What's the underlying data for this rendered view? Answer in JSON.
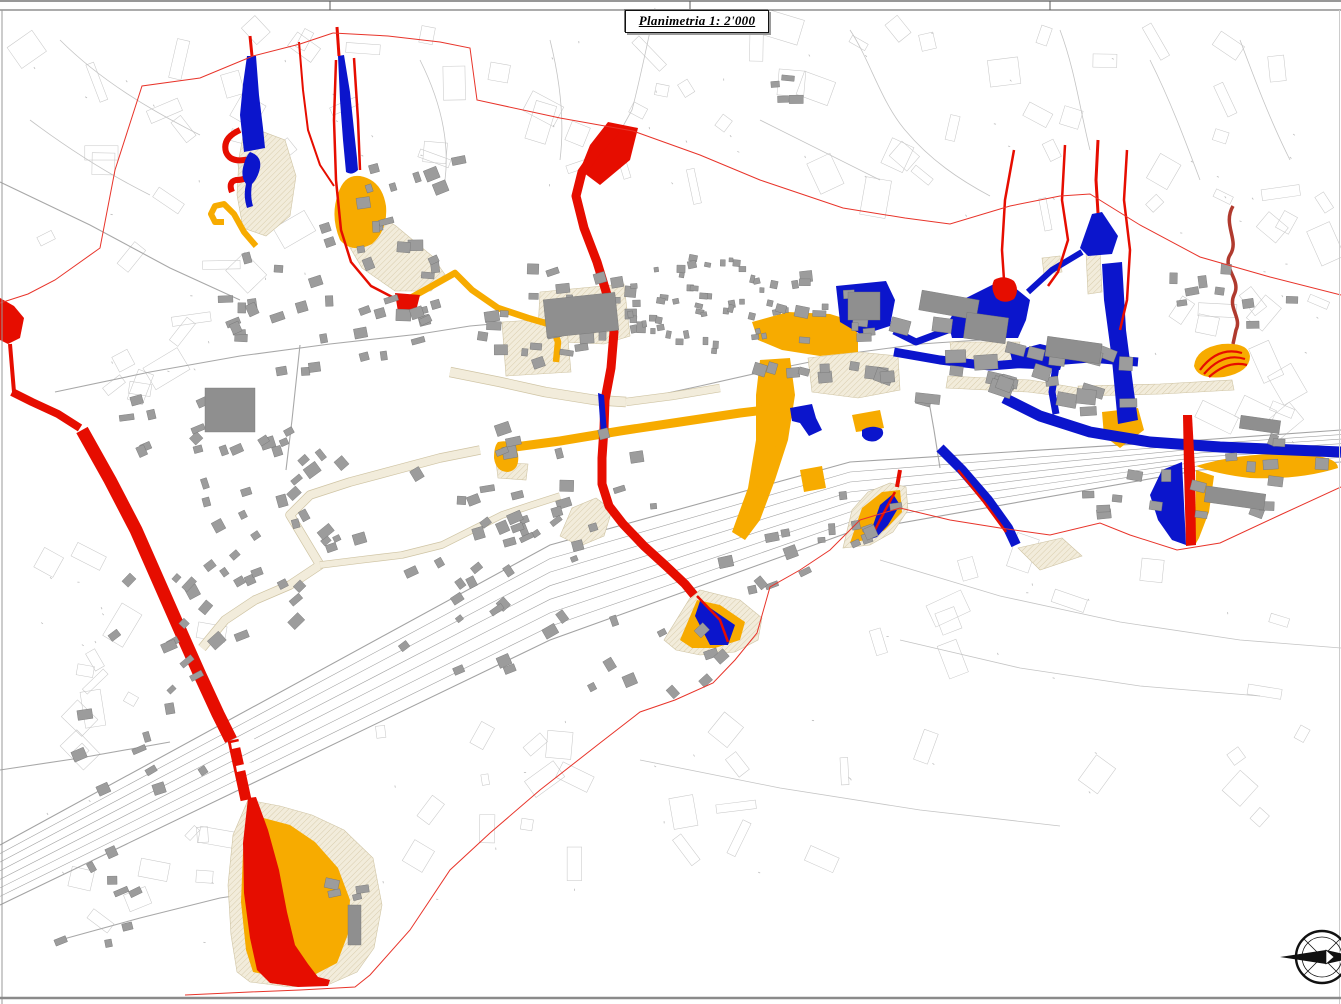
{
  "title_box": {
    "label": "Planimetria 1: 2'000"
  },
  "frame": {
    "band_height": 10,
    "tick_x": [
      330,
      690,
      1050
    ]
  },
  "colors": {
    "paper": "#ffffff",
    "red_zone": "#e60d00",
    "red_perimeter": "#e8342a",
    "dark_red_line": "#b03a2e",
    "blue_zone": "#0b15cc",
    "orange_zone": "#f7ab00",
    "beige_zone": "#f2ecdb",
    "beige_hatch": "#d9cdad",
    "beige_edge": "#cfc4a4",
    "building_fill": "#9c9c9c",
    "building_stroke": "#757575",
    "parcel_line": "#c9c9c9",
    "road_line": "#a8a8a8",
    "rail_line": "#a3a3a3",
    "frame_line": "#5a5a5a"
  },
  "map": {
    "width": 1341,
    "height": 1004,
    "corridor": {
      "top": [
        [
          0,
          845
        ],
        [
          550,
          545
        ],
        [
          850,
          462
        ],
        [
          1200,
          440
        ],
        [
          1341,
          430
        ]
      ],
      "bottom": [
        [
          0,
          905
        ],
        [
          550,
          640
        ],
        [
          850,
          532
        ],
        [
          1200,
          470
        ],
        [
          1341,
          462
        ]
      ],
      "lines": 8
    },
    "roads": [
      "M55,392 L150,372 L240,356 L330,344 L420,334 L470,326 L560,318",
      "M0,182 L90,225 L170,268 L240,300",
      "M626,402 L700,386 L780,368 L860,352",
      "M300,345 L292,420 L286,470",
      "M0,770 L80,758 L170,742",
      "M60,940 L140,918 L220,898 L300,886",
      "M940,468 L934,430 L928,396",
      "M860,352 L920,344 L980,340"
    ],
    "terrain_lines": [
      "M655,8 C648,40 640,80 632,110 L622,128",
      "M850,30 C870,60 880,100 905,130 C930,160 960,180 990,196",
      "M1060,30 C1075,70 1080,110 1090,150",
      "M1150,60 C1170,100 1185,140 1200,180",
      "M760,120 C800,140 840,160 880,180",
      "M60,40 C100,80 150,110 200,135",
      "M30,120 C70,150 110,175 150,195",
      "M1240,40 C1255,80 1270,120 1290,160",
      "M880,560 L1000,596 L1120,622 L1240,640 L1341,648",
      "M900,640 L1020,668 L1140,686 L1260,696",
      "M640,760 L780,788 L920,810 L1060,826",
      "M420,60 C440,100 450,140 445,180",
      "M550,40 C560,80 565,120 560,160",
      "M518,330 L558,330 L558,362 L518,362 Z",
      "M518,338 L558,338",
      "M518,354 L558,354"
    ],
    "beige_zones": [
      "M245,125 L285,140 L296,176 L290,216 L266,236 L243,228 L237,195 L239,158 Z",
      "M341,190 L396,226 L432,256 L446,276 L431,291 L395,291 L362,268 L342,234 Z",
      "M540,292 L624,284 L630,336 L604,344 L560,342 L538,330 Z",
      "M502,322 L566,318 L571,372 L506,376 Z",
      "M560,536 L572,508 L596,498 L612,510 L604,536 L580,546 Z",
      "M496,462 L528,464 L526,480 L498,478 Z",
      "M808,358 L858,352 L898,356 L900,390 L858,398 L812,392 Z",
      "M950,342 L1020,342 L1010,364 L952,358 Z",
      "M1042,258 L1060,256 L1062,272 L1044,274 Z",
      "M1086,252 L1100,250 L1102,292 L1088,294 Z",
      "M1078,386 L1160,384 L1232,380 L1234,390 L1162,394 L1080,396 Z",
      "M1018,548 L1062,538 L1082,556 L1040,570 Z",
      "M248,800 L233,835 L228,885 L231,935 L237,972 L250,982 L290,987 L330,984 L357,972 L374,948 L382,905 L373,858 L344,830 L312,815 L280,806 Z",
      "M664,640 L690,598 L700,590 L740,600 L762,618 L758,640 L735,652 L700,655 L676,650 Z",
      "M843,548 L852,510 L868,492 L890,483 L906,487 L908,510 L893,532 L870,545 Z",
      "M948,376 L1030,380 L1078,388 L1076,398 L1028,392 L946,388 Z"
    ],
    "beige_bands": [
      {
        "d": "M202,648 L225,620 L255,600 L290,585 L320,565 L305,540 L290,515 L310,495 L350,482 L395,470 L440,458 L480,450",
        "w": 8
      },
      {
        "d": "M320,565 L360,560 L402,555 L442,545 L472,530 L502,515 L532,505 L560,496",
        "w": 6
      },
      {
        "d": "M450,372 L500,382 L545,392 L595,400 L626,402",
        "w": 9
      },
      {
        "d": "M626,402 L672,396 L720,388",
        "w": 7
      }
    ],
    "orange_zones": [
      "M752,322 L788,312 L830,314 L856,322 L858,340 L858,352 L820,356 L782,350 L758,340 Z",
      "M760,360 L790,358 L795,395 L788,440 L775,480 L760,520 L745,540 L732,532 L748,488 L756,440 L756,395 Z",
      "M800,470 L822,466 L826,488 L804,492 Z",
      "M338,194 Q344,174 360,176 Q382,180 386,206 Q388,230 372,244 Q352,254 340,240 Q330,216 338,194 Z",
      "M498,442 Q514,438 518,454 Q520,470 508,472 Q496,472 494,458 Q494,446 498,442 Z",
      "M1194,366 Q1196,348 1222,344 Q1248,342 1250,356 Q1250,372 1224,377 Q1198,380 1194,366 Z",
      "M680,640 L697,600 L720,605 L745,622 L740,640 L715,648 L692,648 Z",
      "M850,543 L862,508 L882,492 L900,490 L902,512 L885,530 L865,540 Z",
      "M252,815 L243,852 L241,902 L246,950 L253,972 L282,978 L314,975 L337,963 L348,934 L350,900 L338,868 L315,842 L290,825 Z",
      "M1196,466 Q1250,450 1310,455 Q1338,458 1338,468 Q1300,480 1250,478 Q1216,474 1196,466 Z",
      "M1102,412 L1138,408 L1144,430 L1120,448 L1104,436 Z",
      "M1196,470 L1214,476 L1209,512 L1199,538 L1195,545 Z",
      "M852,415 L880,410 L884,428 L856,432 Z"
    ],
    "orange_bands": [
      {
        "d": "M500,449 L560,441 L620,431 L680,422 L740,413 L790,407",
        "w": 9
      },
      {
        "d": "M770,410 L773,440 L768,468 L760,488",
        "w": 7
      },
      {
        "d": "M405,301 L432,286 L455,273 L472,290 L498,308 L528,318 L552,325",
        "w": 6.5
      },
      {
        "d": "M552,325 L558,342 L556,362",
        "w": 6.5
      },
      {
        "d": "M256,246 L244,232 L234,214 L224,204 L215,206 L211,214 L215,222 L224,222",
        "w": 6
      }
    ],
    "blue_zones": [
      "M247,56 L256,56 L259,95 L263,128 L265,148 L244,152 L240,115 L243,84 Z",
      "M338,56 L344,55 L350,92 L354,130 L357,158 L358,170 Q352,176 346,172 L343,140 L340,100 Z",
      "M790,408 L812,404 L816,418 L822,430 L809,436 L800,423 L792,421 Z",
      "M862,430 Q872,424 882,429 Q886,436 876,441 Q866,443 862,436 Z",
      "M836,286 L886,281 L895,300 L890,326 L862,335 L840,322 Z",
      "M962,300 L996,283 L1014,287 L1030,300 L1026,320 L1018,338 L952,338 L948,322 Z",
      "M1080,248 L1092,214 L1102,212 L1118,236 L1112,254 L1088,256 Z",
      "M1102,264 L1122,262 L1126,330 L1134,392 L1138,420 L1118,424 L1112,360 L1104,300 Z",
      "M1010,352 L1040,344 L1066,350 L1060,370 L1014,368 Z",
      "M1182,462 L1186,545 L1172,540 L1158,520 L1150,495 L1162,470 Z",
      "M700,601 L735,625 L728,645 L710,645 L695,616 Z",
      "M868,540 L880,505 L893,494 L900,505 L888,525 L877,537 Z"
    ],
    "blue_bands": [
      {
        "d": "M948,330 L916,342 L894,331",
        "w": 7
      },
      {
        "d": "M1082,252 L1052,270 L1028,292",
        "w": 6
      },
      {
        "d": "M894,352 L940,360 L990,366 L1040,362 L1090,358 L1138,362",
        "w": 9
      },
      {
        "d": "M1056,366 L1052,392 L1056,414",
        "w": 7
      },
      {
        "d": "M1004,398 L1040,416 L1090,432 L1150,442 L1220,447 L1341,452",
        "w": 11
      },
      {
        "d": "M940,448 L962,470 L988,500 L1008,528 L1016,545",
        "w": 10
      }
    ],
    "blue_top": [
      "M250,152 Q262,156 260,168 Q258,178 252,184 Q250,196 253,206 L247,208 Q243,196 246,184 Q240,176 244,164 Q246,156 250,152 Z",
      "M598,393 L604,395 L607,433 L601,434 Z"
    ],
    "red_zones": [
      "M0,298 L14,306 L24,318 L20,338 L8,344 L0,340 Z",
      "M608,122 L638,128 L630,160 L600,185 L580,170 L590,145 Z",
      "M395,293 L420,295 L415,315 L398,312 Z",
      "M994,280 Q1004,274 1014,281 Q1020,290 1014,299 Q1004,305 996,298 Q990,288 994,280 Z",
      "M248,798 L256,797 L268,830 L279,870 L287,912 L295,945 L308,964 L318,977 L330,980 L328,986 L298,987 L270,983 L257,970 L250,938 L244,893 L243,843 Z",
      "M1183,415 L1192,415 L1195,470 L1196,545 L1186,546 L1184,470 Z"
    ],
    "red_bands": [
      {
        "d": "M10,344 L12,368 L14,392",
        "w": 4
      },
      {
        "d": "M12,392 L32,402 L58,414 L80,428",
        "w": 8
      },
      {
        "d": "M82,430 L110,480 L136,530 L158,580 L180,630 L200,675 L218,714 L231,740",
        "w": 13
      },
      {
        "d": "M233,740 L240,772 L246,800",
        "w": 11
      },
      {
        "d": "M616,130 L596,152 L582,172 L576,196 L584,228 L597,262 L608,298 L614,332 L611,368 L605,400 L604,428 L602,458 L602,484 L609,506 L623,524 L644,546 L666,566 L685,584 L694,595",
        "w": 9
      },
      {
        "d": "M240,130 Q222,138 226,152 Q230,162 244,160 Q254,158 252,170 Q250,180 236,180 Q228,182 232,192",
        "w": 6
      },
      {
        "d": "M336,60 L334,120 L336,180 L341,230 L351,262 L371,286 L396,299",
        "w": 2.5
      },
      {
        "d": "M354,58 L358,120 L360,170",
        "w": 2.5
      },
      {
        "d": "M337,27 L339,56",
        "w": 3
      },
      {
        "d": "M250,36 L252,56",
        "w": 3
      },
      {
        "d": "M299,42 L303,90 L308,130 L320,165 L334,186",
        "w": 2
      },
      {
        "d": "M697,596 L720,620 L728,642",
        "w": 2.5
      },
      {
        "d": "M895,492 L880,520 L870,540",
        "w": 2.5
      },
      {
        "d": "M900,470 L897,487",
        "w": 4
      },
      {
        "d": "M958,470 L984,502 L1006,532",
        "w": 2.5
      },
      {
        "d": "M1014,150 L1005,200 L1002,250 L1004,280",
        "w": 2.5
      },
      {
        "d": "M1065,145 L1062,200 L1068,240 L1058,272 L1048,286",
        "w": 2.5
      },
      {
        "d": "M1098,140 L1096,180 L1098,213",
        "w": 3
      },
      {
        "d": "M1127,150 L1124,200 L1130,250 L1127,300 L1120,330",
        "w": 2.5
      },
      {
        "d": "M1200,370 Q1218,346 1242,353",
        "w": 2.2
      },
      {
        "d": "M1204,374 Q1223,352 1245,359",
        "w": 2.2
      },
      {
        "d": "M1209,377 Q1228,360 1247,365",
        "w": 2.2
      }
    ],
    "dark_red_lines": [
      {
        "d": "M1233,206 C1222,225 1240,240 1230,255 C1222,268 1242,280 1234,295 C1228,308 1242,318 1236,330 L1233,344",
        "w": 3.5
      }
    ],
    "white_gaps": [
      "M231,743 L254,738 L255,744 L232,749 Z",
      "M236,766 L258,761 L259,767 L237,772 Z"
    ],
    "perimeter": [
      "M333,33 L300,44 L253,56 L200,78 L142,86 L115,170 L100,248 L55,280 L28,294 L0,303",
      "M333,33 L388,36 L440,42 L470,48 L477,100 L560,118 L633,131 L700,155 L760,180 L843,208 L905,218 L950,224 L1010,206 L1060,196 L1090,194 L1140,225 L1200,257 L1270,277 L1341,295",
      "M1341,487 L1280,515 L1220,543 L1177,550 L1130,535 L1100,523 L1050,535 L1000,528 L950,520 L900,508 L860,520 L830,550 L800,570 L770,587 L757,633 L735,660 L713,683 L675,700 L640,712 L600,743 L540,790 L490,833 L450,870 L410,930 L370,975 L355,987 L300,990 L250,992 L185,995"
    ],
    "field_regions": [
      {
        "x": 15,
        "y": 30,
        "w": 390,
        "h": 270,
        "n": 24
      },
      {
        "x": 410,
        "y": 35,
        "w": 280,
        "h": 170,
        "n": 14
      },
      {
        "x": 690,
        "y": 25,
        "w": 320,
        "h": 190,
        "n": 16
      },
      {
        "x": 1010,
        "y": 35,
        "w": 320,
        "h": 180,
        "n": 14
      },
      {
        "x": 1150,
        "y": 195,
        "w": 185,
        "h": 170,
        "n": 10
      },
      {
        "x": 15,
        "y": 555,
        "w": 210,
        "h": 210,
        "n": 12
      },
      {
        "x": 370,
        "y": 690,
        "w": 320,
        "h": 220,
        "n": 12
      },
      {
        "x": 850,
        "y": 545,
        "w": 480,
        "h": 300,
        "n": 16
      },
      {
        "x": 40,
        "y": 310,
        "w": 170,
        "h": 110,
        "n": 7
      },
      {
        "x": 620,
        "y": 690,
        "w": 260,
        "h": 190,
        "n": 8
      },
      {
        "x": 1180,
        "y": 300,
        "w": 160,
        "h": 160,
        "n": 8
      },
      {
        "x": 20,
        "y": 800,
        "w": 200,
        "h": 150,
        "n": 8
      }
    ],
    "building_clusters": [
      [
        330,
        300,
        120,
        80,
        40,
        -10,
        0
      ],
      [
        560,
        320,
        85,
        55,
        26,
        -5,
        0
      ],
      [
        705,
        305,
        80,
        48,
        48,
        0,
        1
      ],
      [
        805,
        330,
        70,
        55,
        22,
        5,
        0
      ],
      [
        945,
        362,
        85,
        45,
        16,
        8,
        2
      ],
      [
        1080,
        382,
        75,
        38,
        12,
        8,
        2
      ],
      [
        1225,
        300,
        70,
        45,
        9,
        0,
        0
      ],
      [
        300,
        480,
        130,
        70,
        28,
        -30,
        0
      ],
      [
        560,
        480,
        110,
        60,
        20,
        -10,
        0
      ],
      [
        215,
        620,
        110,
        80,
        24,
        -35,
        0
      ],
      [
        480,
        612,
        100,
        60,
        16,
        -30,
        0
      ],
      [
        645,
        655,
        80,
        48,
        10,
        -30,
        0
      ],
      [
        130,
        760,
        80,
        60,
        9,
        -20,
        0
      ],
      [
        875,
        520,
        80,
        30,
        9,
        -15,
        0
      ],
      [
        1165,
        500,
        110,
        28,
        11,
        8,
        0
      ],
      [
        1280,
        460,
        55,
        22,
        7,
        8,
        0
      ],
      [
        430,
        205,
        90,
        50,
        11,
        -10,
        0
      ],
      [
        180,
        425,
        60,
        40,
        9,
        -15,
        0
      ],
      [
        95,
        900,
        60,
        50,
        8,
        -15,
        0
      ],
      [
        352,
        885,
        30,
        55,
        4,
        0,
        0
      ],
      [
        792,
        82,
        32,
        20,
        4,
        0,
        0
      ],
      [
        520,
        545,
        60,
        35,
        10,
        -25,
        0
      ],
      [
        760,
        560,
        60,
        35,
        8,
        -25,
        0
      ]
    ],
    "buildings_large": [
      [
        545,
        296,
        72,
        38,
        -6
      ],
      [
        205,
        388,
        50,
        44,
        0
      ],
      [
        848,
        292,
        32,
        28,
        0
      ],
      [
        920,
        295,
        58,
        20,
        10
      ],
      [
        1046,
        340,
        55,
        20,
        8
      ],
      [
        965,
        315,
        42,
        26,
        8
      ],
      [
        1205,
        490,
        60,
        16,
        8
      ],
      [
        1240,
        418,
        40,
        13,
        8
      ],
      [
        348,
        905,
        13,
        40,
        0
      ]
    ],
    "compass": {
      "cx": 1322,
      "cy": 957,
      "r": 26
    }
  }
}
